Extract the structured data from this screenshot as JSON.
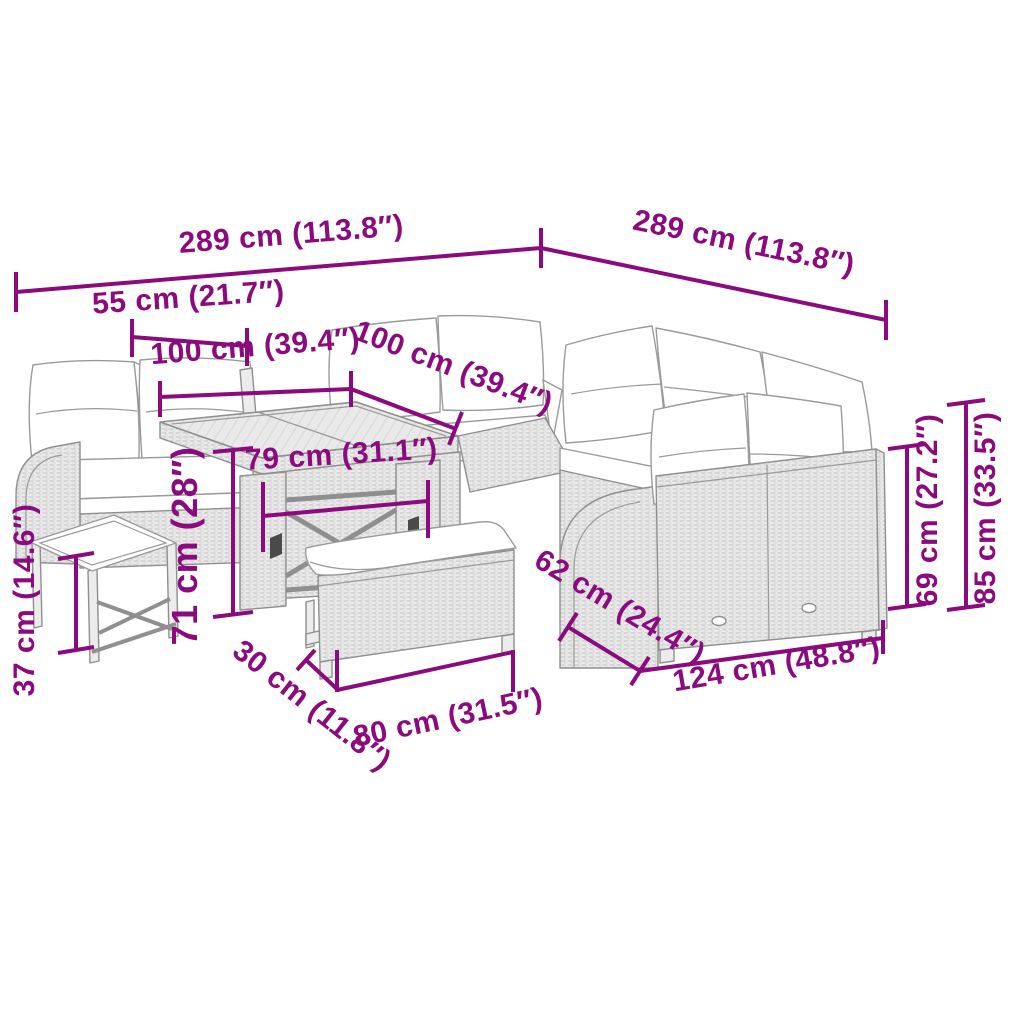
{
  "meta": {
    "type": "product-dimension-diagram",
    "subject": "garden-lounge-set-with-table-benches",
    "background_color": "#ffffff",
    "accent_color": "#8b0a7d",
    "artwork_outline_color": "#8f8f8f"
  },
  "scene": {
    "parts": [
      "left-sofa",
      "back-sofa-row",
      "corner-wing-sofa",
      "right-sofa",
      "glass-top-table",
      "arch-side-panel",
      "footstool",
      "bench"
    ]
  },
  "dimensions": {
    "overall_depth_left": {
      "label": "289 cm (113.8″)"
    },
    "overall_width_right": {
      "label": "289 cm (113.8″)"
    },
    "stool_width": {
      "label": "55 cm (21.7″)"
    },
    "module_width_left": {
      "label": "100 cm (39.4″)"
    },
    "module_width_right": {
      "label": "100 cm (39.4″)"
    },
    "table_top_width": {
      "label": "79 cm (31.1″)"
    },
    "table_height": {
      "label": "71 cm (28″)"
    },
    "stool_height": {
      "label": "37 cm (14.6″)"
    },
    "bench_depth": {
      "label": "30 cm (11.8″)"
    },
    "bench_width": {
      "label": "80 cm (31.5″)"
    },
    "sofa_depth": {
      "label": "62 cm (24.4″)"
    },
    "sofa_width": {
      "label": "124 cm (48.8″)"
    },
    "seat_back_height": {
      "label": "69 cm (27.2″)"
    },
    "total_height": {
      "label": "85 cm (33.5″)"
    }
  }
}
